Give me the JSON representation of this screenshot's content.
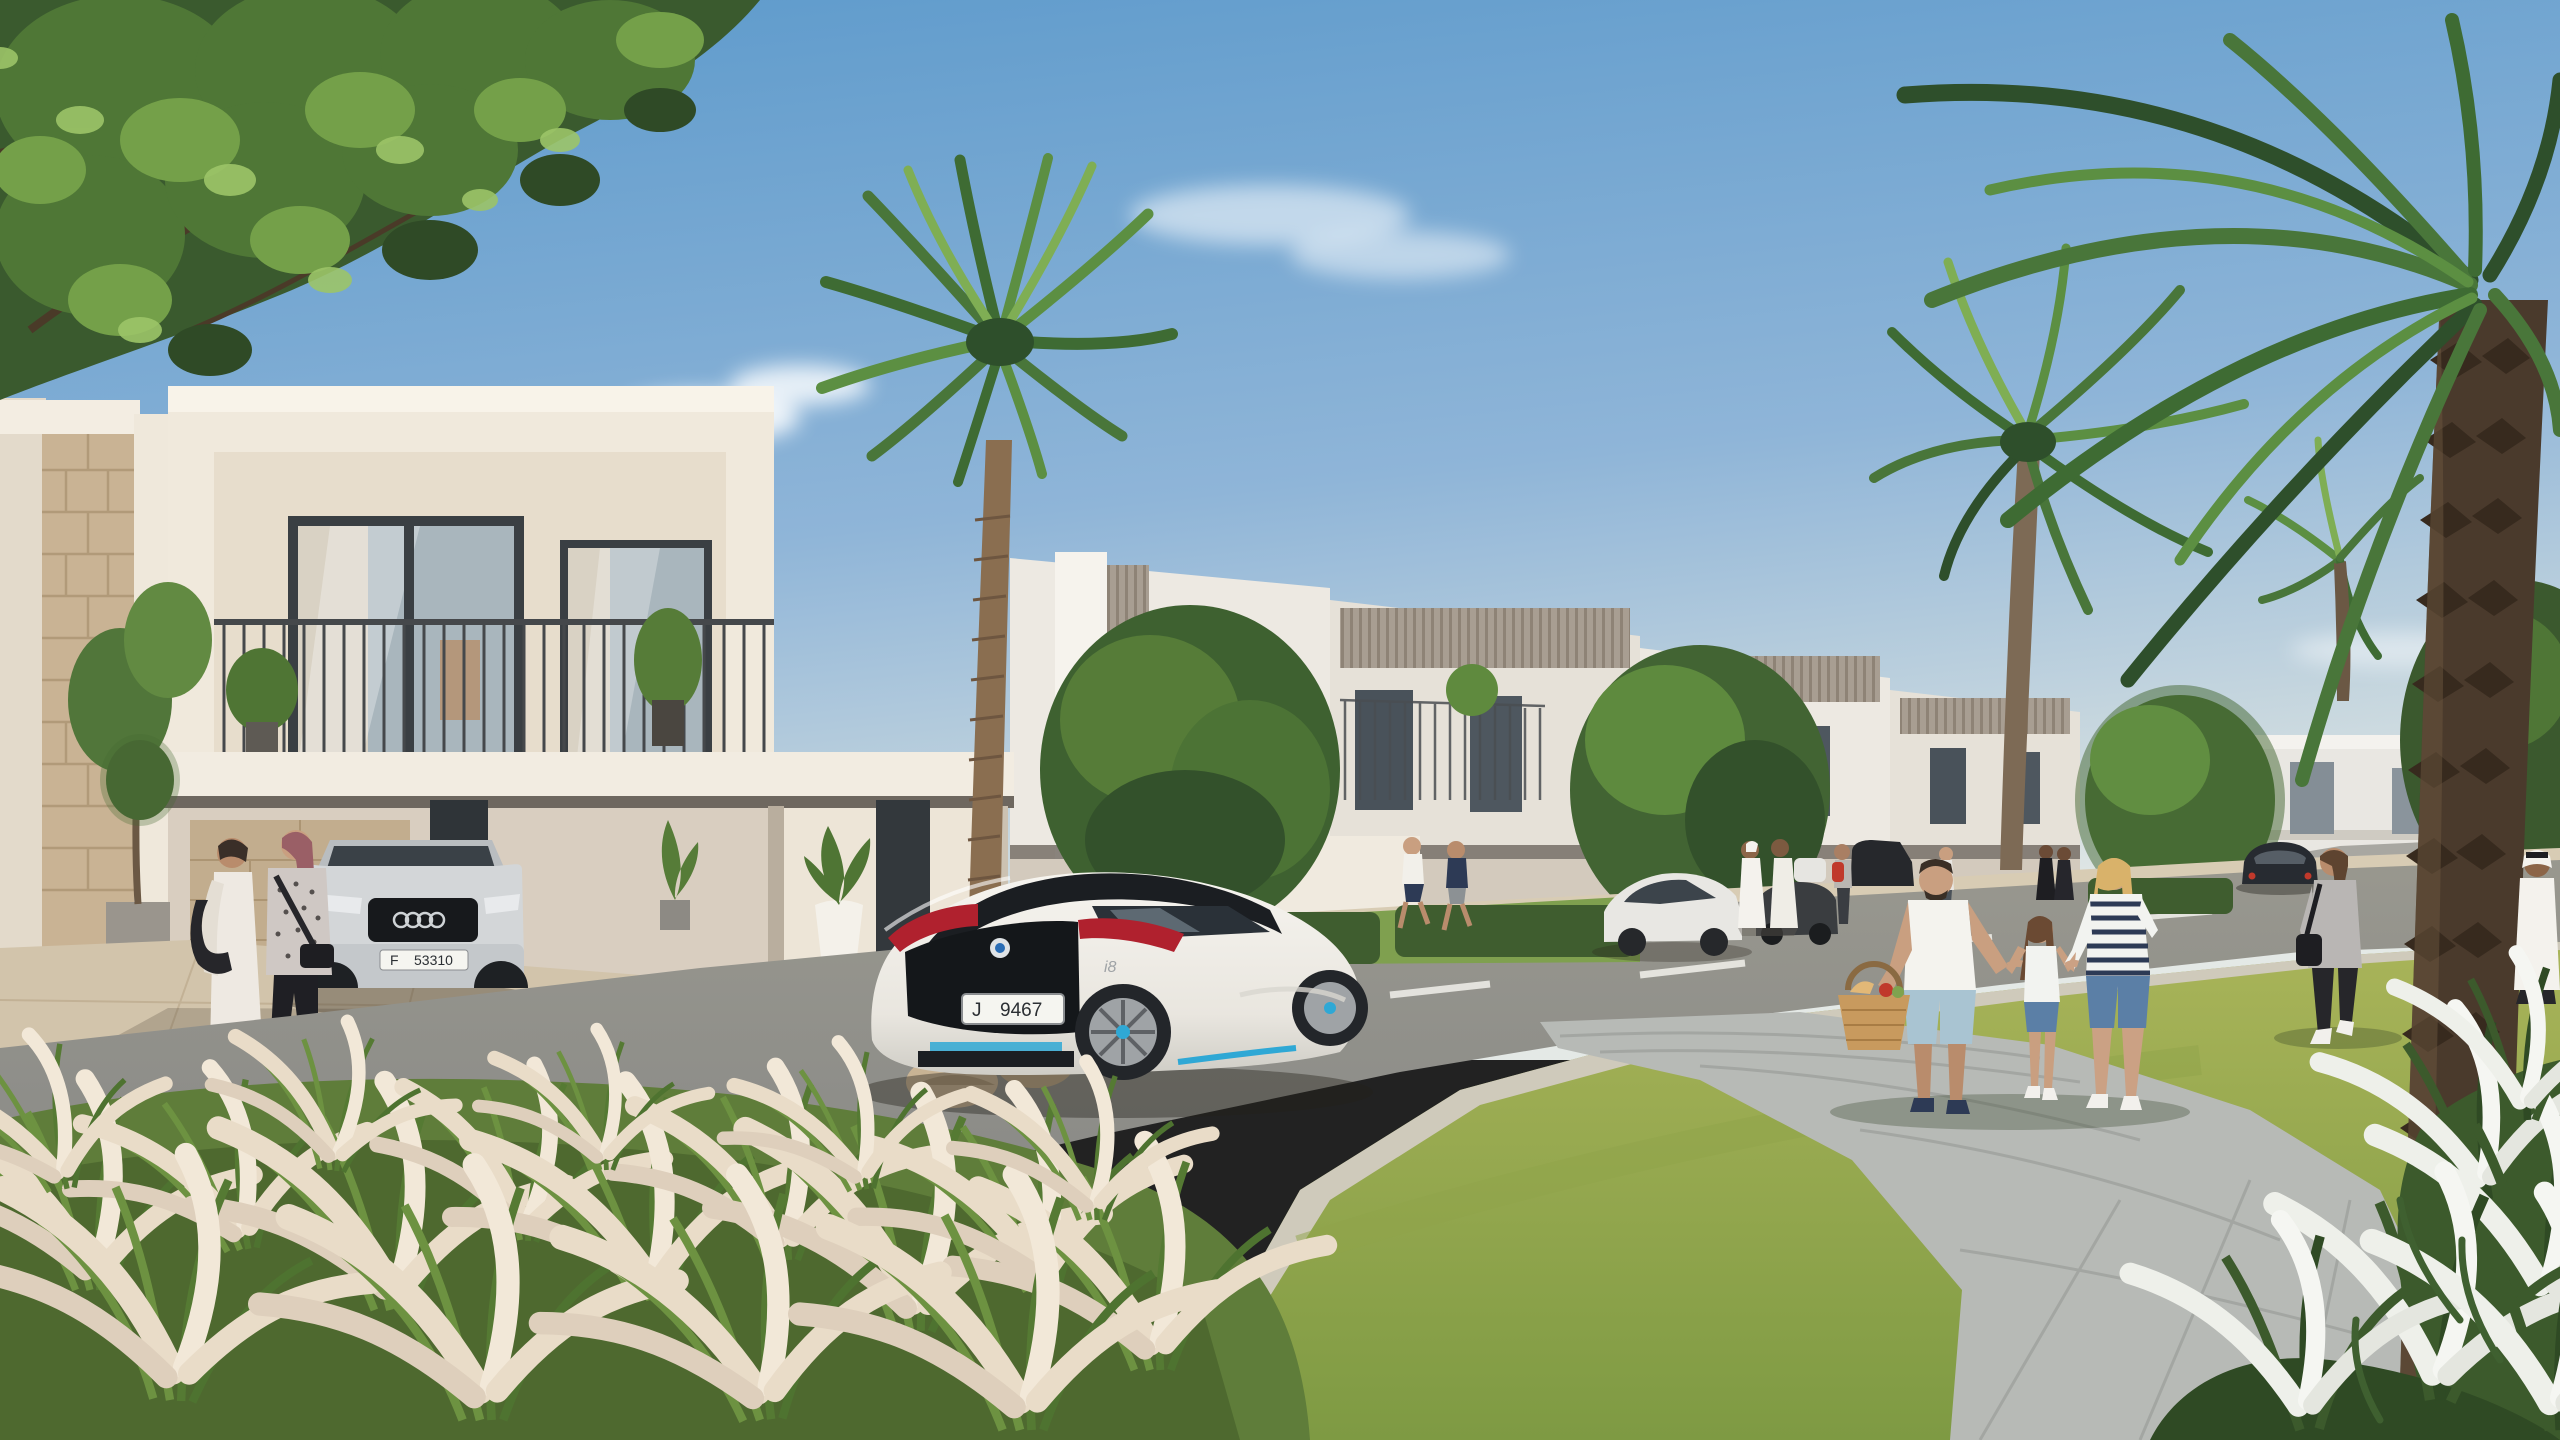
{
  "scene": {
    "description": "Sunny architectural rendering of a modern townhouse community street: white BMW i8 coupe on the road, residents strolling, family walking a curved paver path, date palms and ornamental grasses",
    "sky": "clear blue, faint clouds",
    "buildings": "rows of two-storey white and warm-grey townhouses with balconies, louvre panels and carports"
  },
  "vehicles": {
    "sports_coupe": {
      "kind": "white sports coupe with black roof, red tail lights and blue accents",
      "badge": "i8",
      "plate": {
        "letter": "J",
        "number": "9467"
      }
    },
    "estate_car": {
      "kind": "silver estate car parked in carport",
      "plate": {
        "letter": "F",
        "number": "53310"
      }
    },
    "parked_sedan": {
      "kind": "white sedan in driveway"
    },
    "dark_suv": {
      "kind": "dark SUV in driveway"
    },
    "distant_car": {
      "kind": "dark sedan driving away on road"
    }
  },
  "people": {
    "left_women": "two women walking past carport, one in white dress with black bag, one in patterned top with mauve hair",
    "joggers": "two men jogging on far sidewalk",
    "emirati_men": "two men in white kanduras talking",
    "backpack_walker": "woman with red backpack",
    "dark_pair": "two figures in dark abayas",
    "family": {
      "father": "man in white t-shirt and light blue shorts carrying picnic basket",
      "daughter": "girl in white top and denim shorts holding hands",
      "mother": "blonde woman in navy striped top and denim shorts"
    },
    "woman_walking_away": "woman in grey tee and black jeans with shoulder bag",
    "emirati_man_right": "man in white kandura walking toward viewer"
  },
  "palette": {
    "sky_top": "#5B99CB",
    "sky_horizon": "#DDE4E3",
    "wall_cream": "#F0E9DC",
    "stone": "#C9B394",
    "road": "#8C8C88",
    "lawn": "#A4B156",
    "palm_green": "#49763A",
    "plume": "#EADCC9",
    "accent_blue": "#2FA8D5",
    "tail_red": "#B0212E"
  }
}
